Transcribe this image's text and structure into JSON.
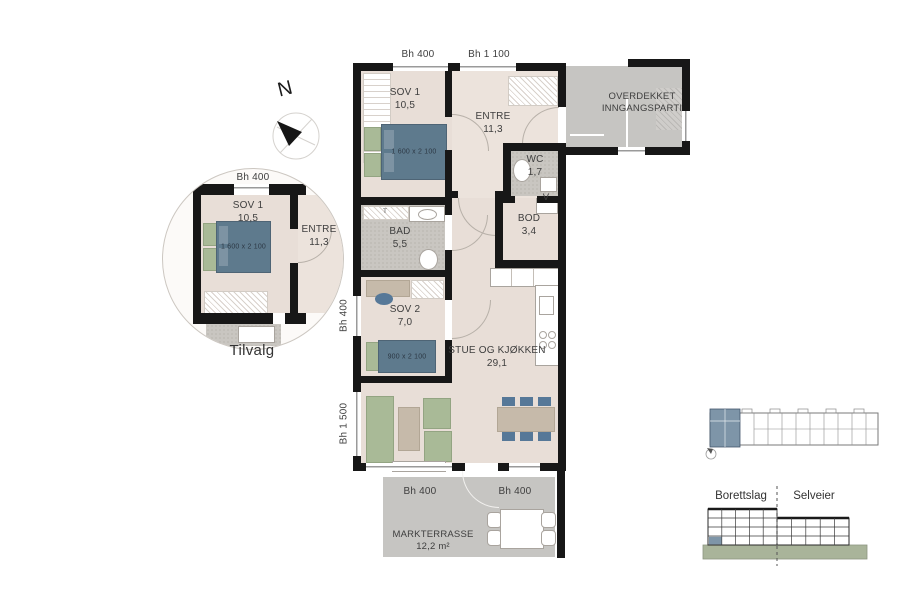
{
  "north_label": "N",
  "plan": {
    "dim_top_left": "Bh 400",
    "dim_top_right": "Bh 1 100",
    "dim_left_upper": "Bh 400",
    "dim_left_lower": "Bh 1 500",
    "dim_bottom_left": "Bh 400",
    "dim_bottom_right": "Bh 400",
    "rooms": {
      "sov1": {
        "name": "SOV 1",
        "area": "10,5"
      },
      "entre": {
        "name": "ENTRE",
        "area": "11,3"
      },
      "wc": {
        "name": "WC",
        "area": "1,7"
      },
      "bod": {
        "name": "BOD",
        "area": "3,4"
      },
      "bad": {
        "name": "BAD",
        "area": "5,5"
      },
      "sov2": {
        "name": "SOV 2",
        "area": "7,0"
      },
      "stue": {
        "name": "STUE OG KJØKKEN",
        "area": "29,1"
      }
    },
    "overdekket_line1": "OVERDEKKET",
    "overdekket_line2": "INNGANGSPARTI",
    "v_marker": "V",
    "t_marker": "T",
    "radiator": "RADIATOR",
    "bed1_size": "1 600 x 2 100",
    "bed2_size": "900 x 2 100",
    "terrace": {
      "name": "MARKTERRASSE",
      "area": "12,2 m²"
    }
  },
  "tilvalg": {
    "caption": "Tilvalg",
    "dim_top": "Bh 400",
    "sov1_name": "SOV 1",
    "sov1_area": "10,5",
    "bed_size": "1 600 x 2 100",
    "entre_name": "ENTRE",
    "entre_area": "11,3"
  },
  "legend": {
    "left": "Borettslag",
    "right": "Selveier"
  },
  "colors": {
    "floor": "#e8ded7",
    "tile": "#c9c6c1",
    "outdoor": "#c6c5c2",
    "wall": "#171717",
    "bed_blue": "#5e7a8d",
    "chair_blue": "#567898",
    "furniture_green": "#a9ba97",
    "furniture_tan": "#c6baaa",
    "unit_highlight": "#7e95a8",
    "ground_green": "#a9b49a"
  }
}
